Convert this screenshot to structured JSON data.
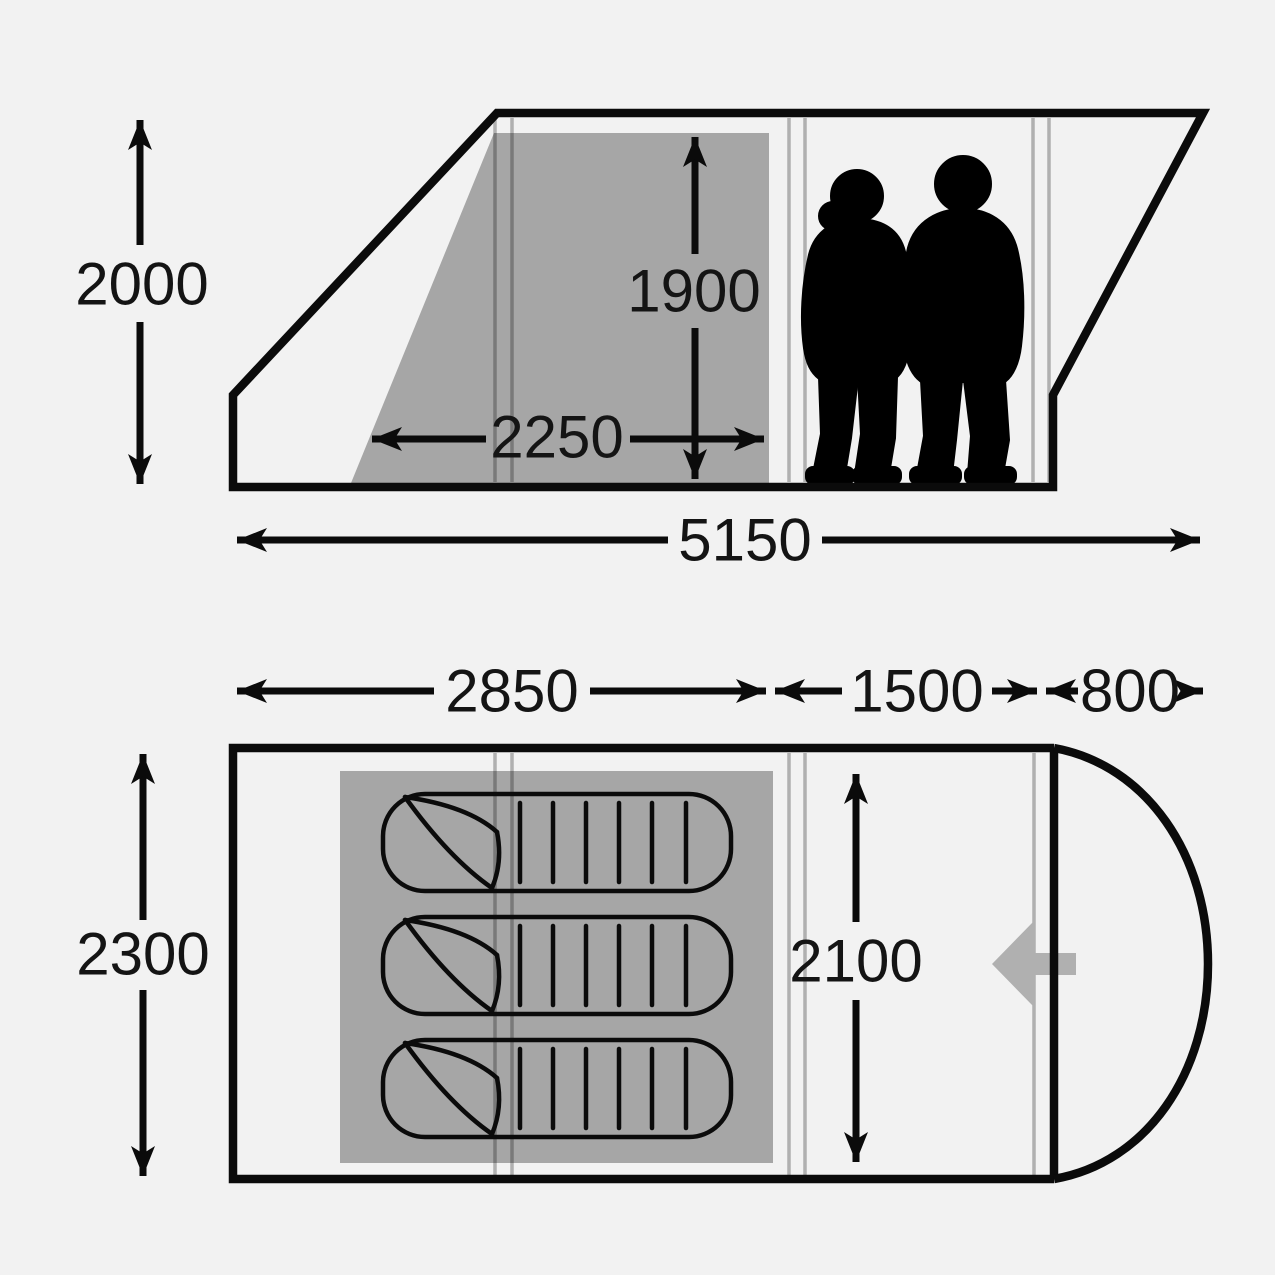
{
  "diagram": {
    "kind": "tent dimension diagram",
    "views": {
      "side_view_name": "side elevation",
      "floor_plan_name": "floor plan"
    }
  },
  "colors": {
    "background": "#f2f2f2",
    "line": "#0b0b0b",
    "inner_shade": "#a6a6a6",
    "pole_line": "#b5b5b5",
    "entrance_arrow": "#b0b0b0",
    "silhouette": "#000000"
  },
  "side_view": {
    "dimensions": [
      {
        "id": "overall-height",
        "label": "2000",
        "orientation": "vertical"
      },
      {
        "id": "headroom-height",
        "label": "1900",
        "orientation": "vertical"
      },
      {
        "id": "bedroom-depth",
        "label": "2250",
        "orientation": "horizontal"
      },
      {
        "id": "overall-length",
        "label": "5150",
        "orientation": "horizontal"
      }
    ],
    "figures": [
      {
        "icon": "woman-silhouette"
      },
      {
        "icon": "man-silhouette"
      }
    ]
  },
  "floor_plan": {
    "dimensions": [
      {
        "id": "bedroom-length",
        "label": "2850",
        "orientation": "horizontal"
      },
      {
        "id": "living-length",
        "label": "1500",
        "orientation": "horizontal"
      },
      {
        "id": "porch-length",
        "label": "800",
        "orientation": "horizontal"
      },
      {
        "id": "overall-width",
        "label": "2300",
        "orientation": "vertical"
      },
      {
        "id": "inner-width",
        "label": "2100",
        "orientation": "vertical"
      }
    ],
    "sleeping_bag_count": 3,
    "entrance": {
      "icon": "entrance-arrow-left"
    }
  }
}
